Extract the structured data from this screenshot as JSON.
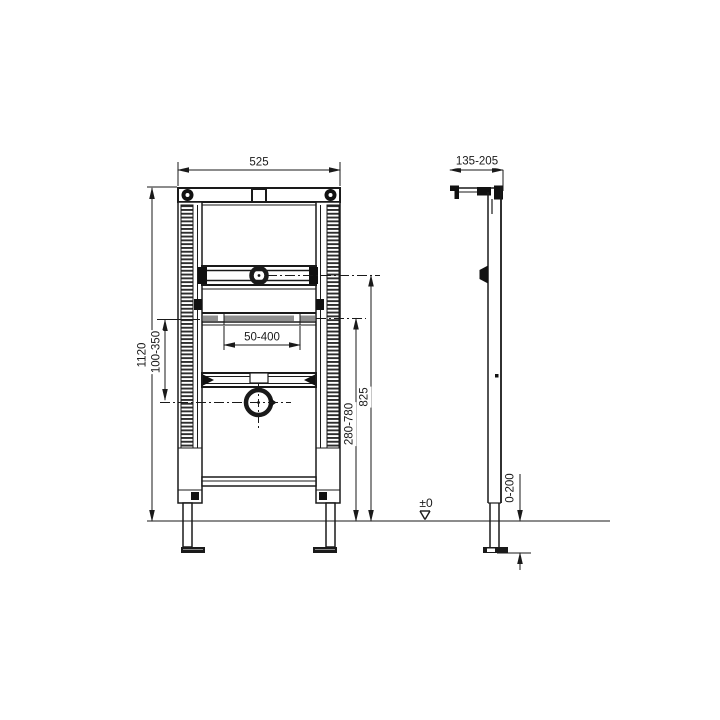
{
  "drawing": {
    "views": {
      "front_view": "front-elevation-of-mounting-frame",
      "side_view": "side-profile-of-mounting-frame"
    },
    "dimensions": {
      "frame_width": "525",
      "frame_height": "1120",
      "left_adjust_range": "100-350",
      "slot_spacing_range": "50-400",
      "outlet_centre_height": "825",
      "lower_rail_height_range": "280-780",
      "wall_bracket_depth": "135-205",
      "foot_extension_range": "0-200",
      "floor_level": "±0"
    },
    "colors": {
      "line": "#1a1a1a",
      "hatch_dark": "#2e2e2e",
      "slot_gray": "#8f8f8f",
      "background": "#ffffff"
    }
  }
}
